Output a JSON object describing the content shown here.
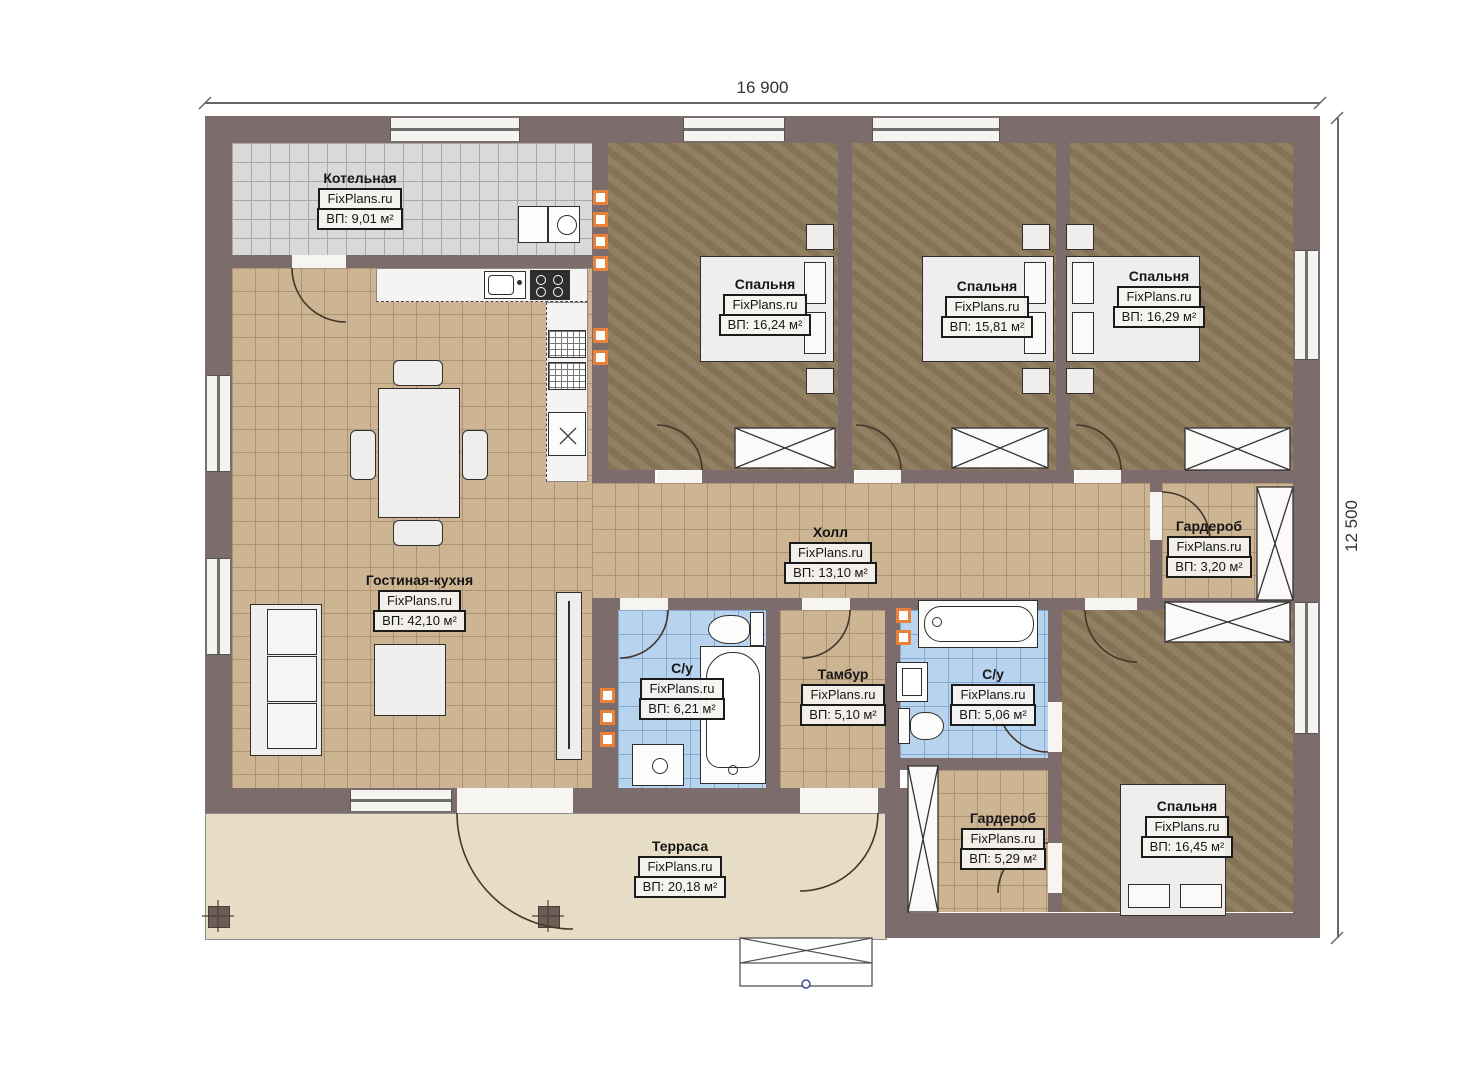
{
  "watermark": "FixPlans.ru",
  "dimensions": {
    "width": "16 900",
    "height": "12 500"
  },
  "rooms": [
    {
      "name": "Котельная",
      "area": "ВП: 9,01 м²"
    },
    {
      "name": "Спальня",
      "area": "ВП: 16,24 м²"
    },
    {
      "name": "Спальня",
      "area": "ВП: 15,81 м²"
    },
    {
      "name": "Спальня",
      "area": "ВП: 16,29 м²"
    },
    {
      "name": "Гостиная-кухня",
      "area": "ВП: 42,10 м²"
    },
    {
      "name": "Холл",
      "area": "ВП: 13,10 м²"
    },
    {
      "name": "Гардероб",
      "area": "ВП: 3,20 м²"
    },
    {
      "name": "С/у",
      "area": "ВП: 6,21 м²"
    },
    {
      "name": "Тамбур",
      "area": "ВП: 5,10 м²"
    },
    {
      "name": "С/у",
      "area": "ВП: 5,06 м²"
    },
    {
      "name": "Гардероб",
      "area": "ВП: 5,29 м²"
    },
    {
      "name": "Спальня",
      "area": "ВП: 16,45 м²"
    },
    {
      "name": "Терраса",
      "area": "ВП: 20,18 м²"
    }
  ],
  "colors": {
    "wall": "#7d6c6c",
    "tile_tan": "#cdb593",
    "tile_gray": "#d9d9d7",
    "tile_blue": "#b8d3ee",
    "floor_wood": "#8d7b5c",
    "terrace": "#e7ddc7",
    "accent_orange": "#e8823b"
  }
}
